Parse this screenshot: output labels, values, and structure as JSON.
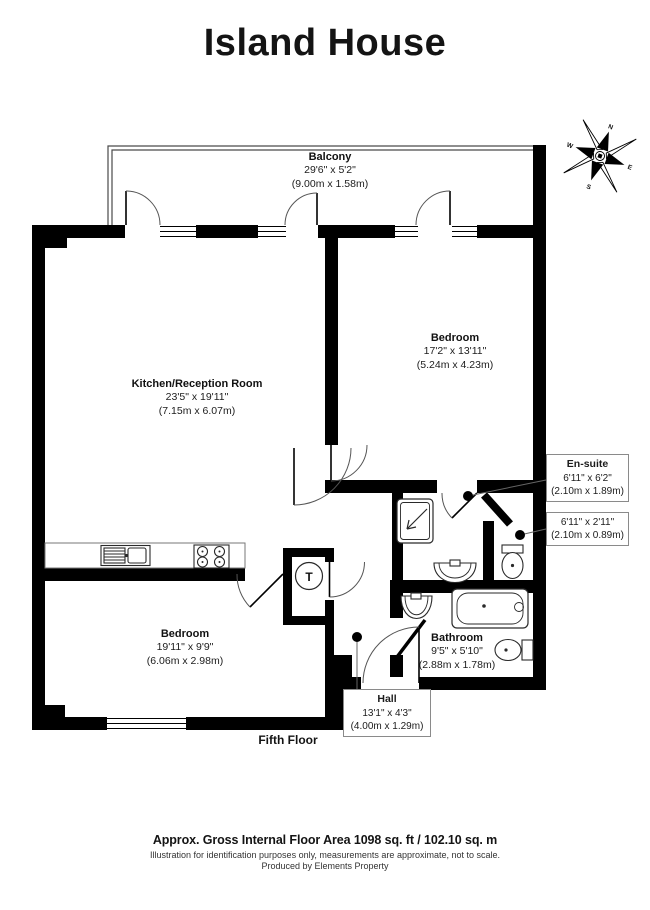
{
  "title": "Island House",
  "floor_label": "Fifth Floor",
  "compass": {
    "n": "N",
    "e": "E",
    "s": "S",
    "w": "W"
  },
  "rooms": {
    "balcony": {
      "name": "Balcony",
      "imperial": "29'6\" x 5'2\"",
      "metric": "(9.00m x 1.58m)"
    },
    "kitchen_reception": {
      "name": "Kitchen/Reception Room",
      "imperial": "23'5\" x 19'11\"",
      "metric": "(7.15m x 6.07m)"
    },
    "bedroom_right": {
      "name": "Bedroom",
      "imperial": "17'2\" x 13'11\"",
      "metric": "(5.24m x 4.23m)"
    },
    "bedroom_left": {
      "name": "Bedroom",
      "imperial": "19'11\" x 9'9\"",
      "metric": "(6.06m x 2.98m)"
    },
    "ensuite": {
      "name": "En-suite",
      "imperial": "6'11\" x 6'2\"",
      "metric": "(2.10m x 1.89m)"
    },
    "wc": {
      "imperial": "6'11\" x 2'11\"",
      "metric": "(2.10m x 0.89m)"
    },
    "bathroom": {
      "name": "Bathroom",
      "imperial": "9'5\" x 5'10\"",
      "metric": "(2.88m x 1.78m)"
    },
    "hall": {
      "name": "Hall",
      "imperial": "13'1\" x 4'3\"",
      "metric": "(4.00m x 1.29m)"
    }
  },
  "fixtures": {
    "tank_label": "T"
  },
  "footer": {
    "area_line": "Approx. Gross Internal Floor Area 1098 sq. ft / 102.10 sq. m",
    "disclaimer_line": "Illustration for identification purposes only, measurements are approximate, not to scale.",
    "credit_line": "Produced by Elements Property"
  },
  "colors": {
    "wall": "#000000",
    "line": "#555555",
    "background": "#ffffff",
    "label_box_border": "#8a8a8a"
  }
}
